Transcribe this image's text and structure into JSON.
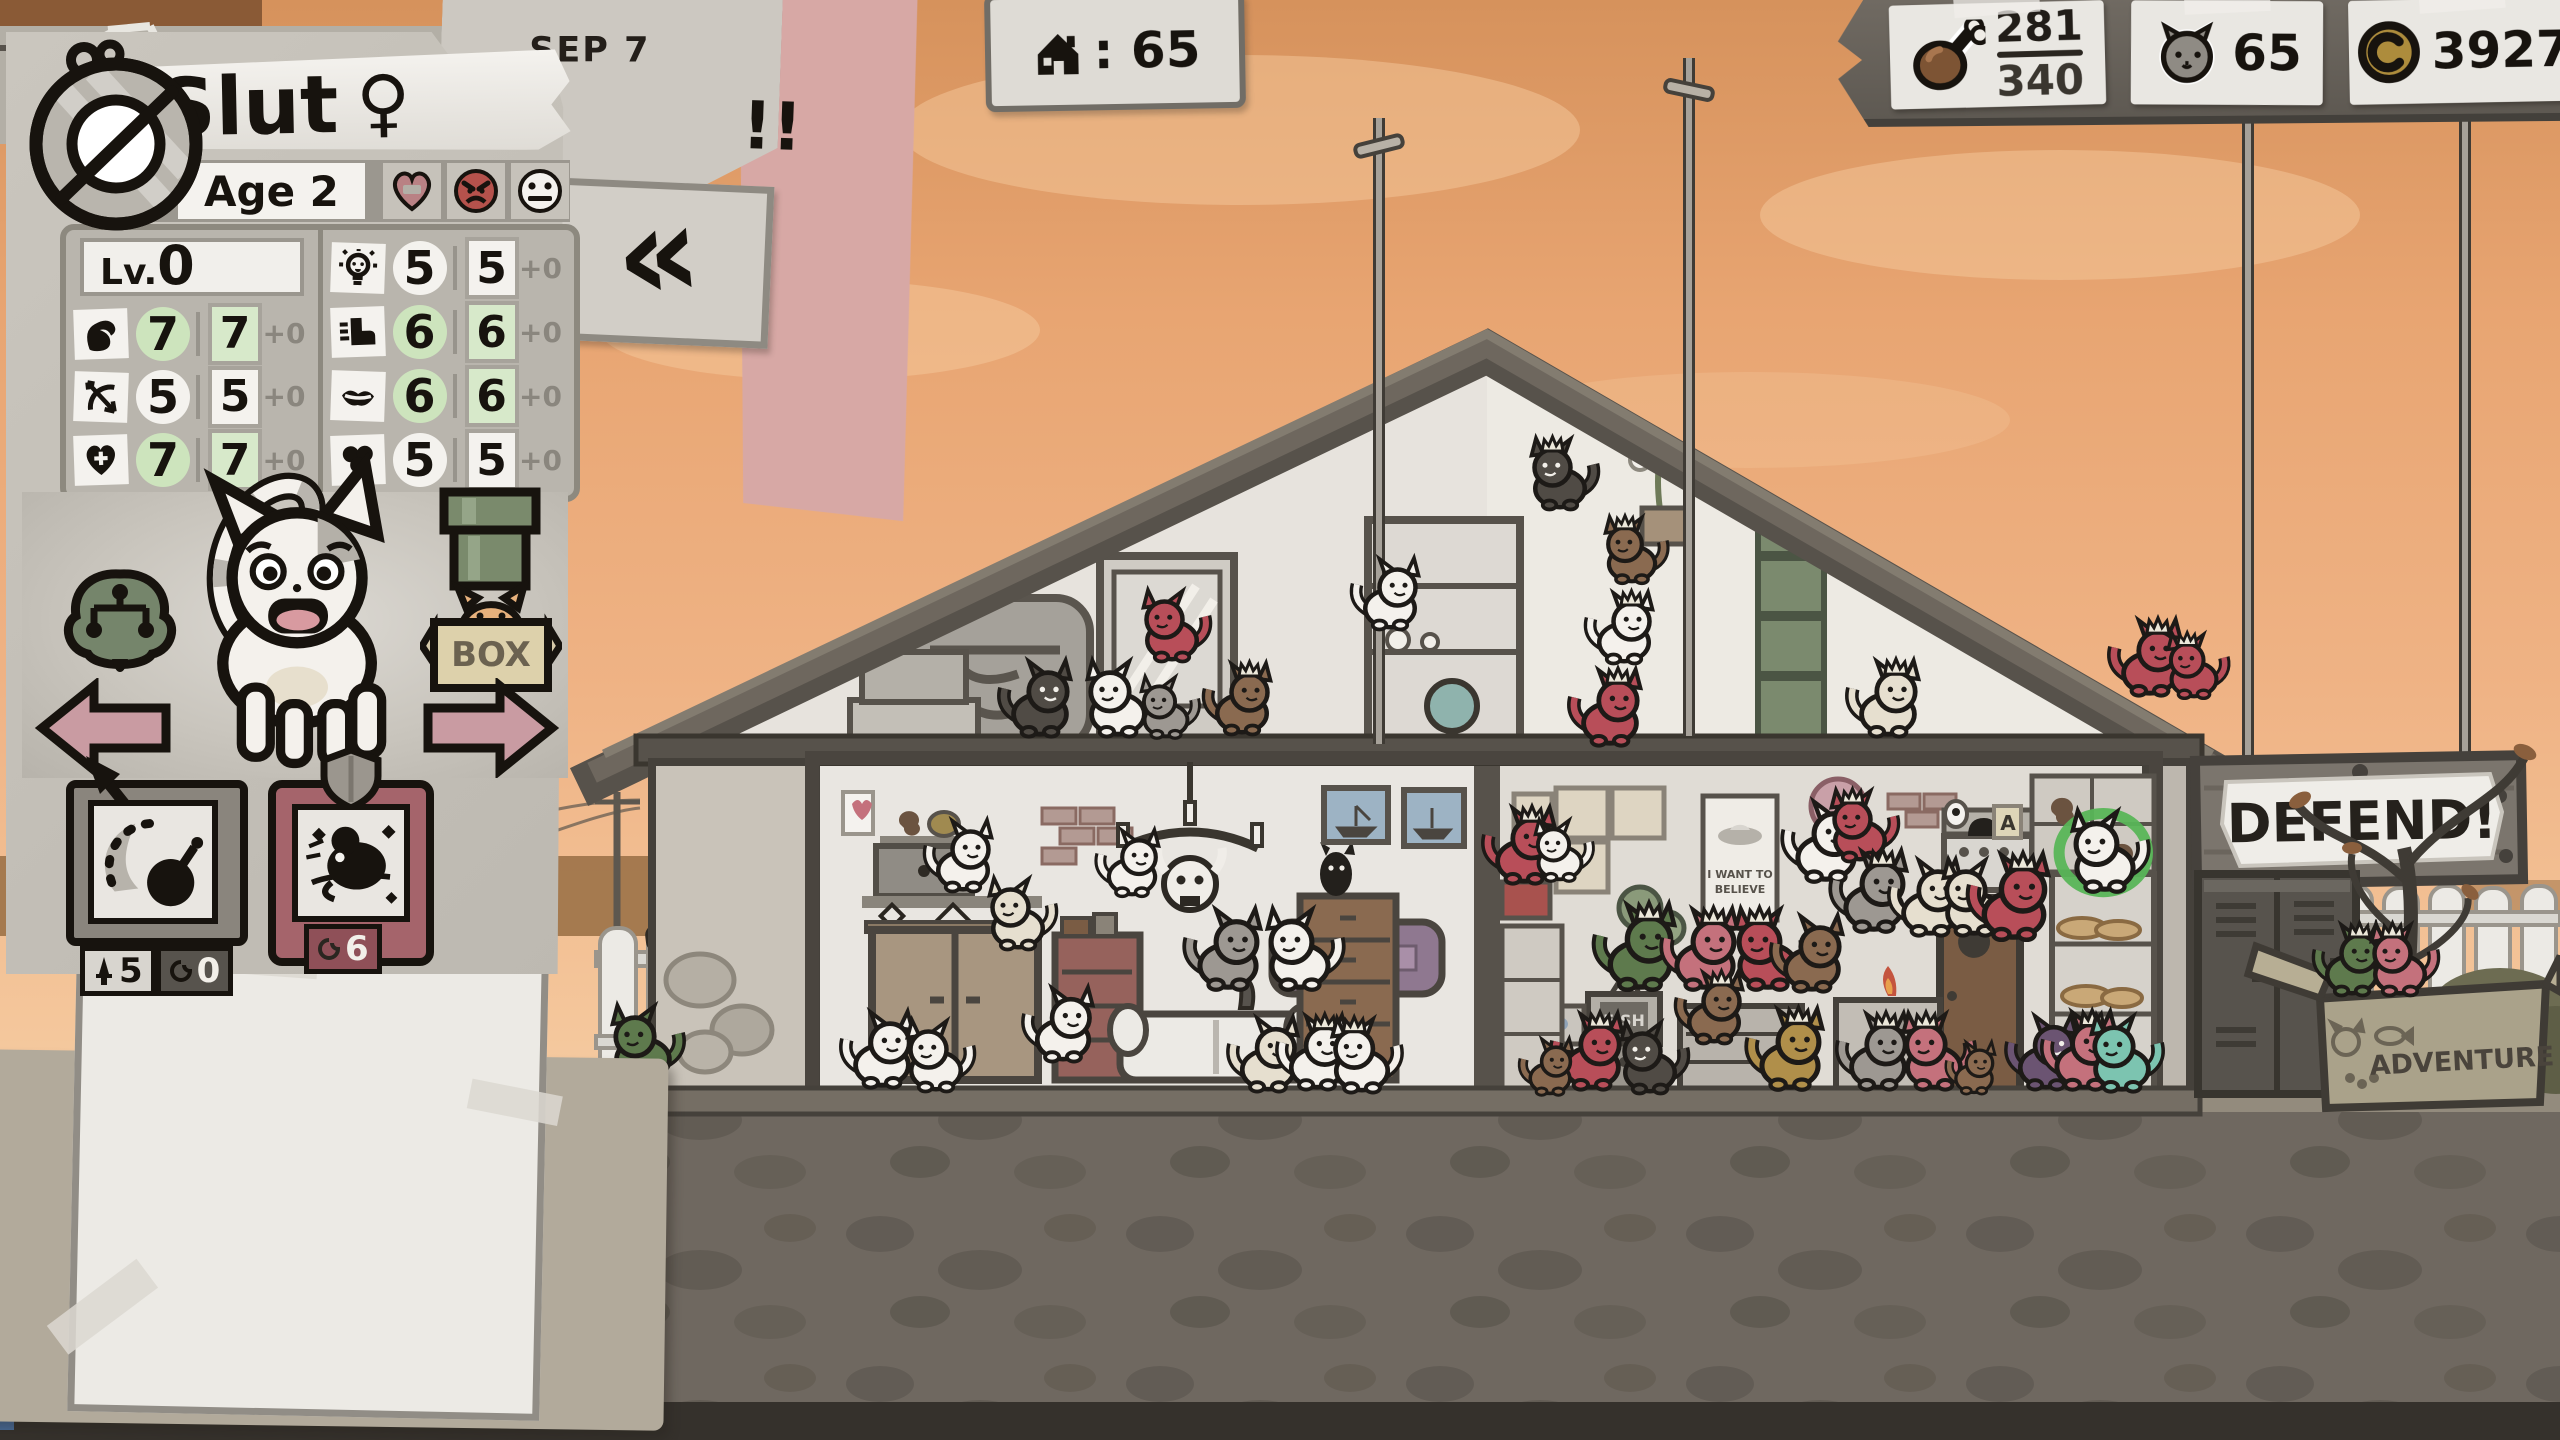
{
  "hud": {
    "date": "Sep 7",
    "date_alert": "!!",
    "back_button_glyph": "«",
    "house_counter": {
      "icon": "house-icon",
      "value": ": 65"
    },
    "resources": {
      "food": {
        "icon": "drumstick-icon",
        "current": "281",
        "max": "340"
      },
      "cats": {
        "icon": "cat-head-icon",
        "value": "65"
      },
      "coins": {
        "icon": "coin-icon",
        "value": "3927"
      }
    }
  },
  "character": {
    "badge": "prohibition-medallion",
    "name": "Slut",
    "gender": "♀",
    "age": "Age 2",
    "level_label": "Lv.",
    "level_value": "0",
    "moods": [
      "heart-minus",
      "angry-face",
      "neutral-face"
    ],
    "stats_left": [
      {
        "stat": "strength",
        "base": "7",
        "current": "7",
        "mod": "+0",
        "green": true
      },
      {
        "stat": "dexterity",
        "base": "5",
        "current": "5",
        "mod": "+0",
        "green": false
      },
      {
        "stat": "vitality",
        "base": "7",
        "current": "7",
        "mod": "+0",
        "green": true
      }
    ],
    "stats_right": [
      {
        "stat": "intelligence",
        "base": "5",
        "current": "5",
        "mod": "+0",
        "green": false
      },
      {
        "stat": "speed",
        "base": "6",
        "current": "6",
        "mod": "+0",
        "green": true
      },
      {
        "stat": "charisma",
        "base": "6",
        "current": "6",
        "mod": "+0",
        "green": true
      },
      {
        "stat": "luck",
        "base": "5",
        "current": "5",
        "mod": "+0",
        "green": false
      }
    ],
    "box_button": "BOX",
    "abilities": [
      {
        "name": "bomb-lob",
        "attack": "5",
        "uses": "0"
      },
      {
        "name": "rat",
        "uses": "6"
      }
    ]
  },
  "scene": {
    "defend_sign": "DEFEND!",
    "adventure_box_label": "ADVENTURE",
    "poster_line1": "I WANT TO",
    "poster_line2": "BELIEVE",
    "tv_label": "FISH",
    "shelf_tag": "A",
    "cat_colors": {
      "W": "#f4f1ec",
      "G": "#9d9892",
      "D": "#504b45",
      "R": "#b84e59",
      "P": "#c4717c",
      "N": "#8a6a50",
      "V": "#5e7a4d",
      "T": "#7cc4b0",
      "C": "#e6dfcf",
      "O": "#b08f4a",
      "U": "#6b5472"
    },
    "dark_eye_colors": [
      "D",
      "U"
    ],
    "selection_color": "#58b557",
    "cats": [
      {
        "x": 1040,
        "y": 735,
        "s": 0.8,
        "c": "D"
      },
      {
        "x": 1118,
        "y": 735,
        "s": 0.8,
        "c": "W",
        "f": 1
      },
      {
        "x": 1166,
        "y": 737,
        "s": 0.65,
        "c": "G",
        "f": 1
      },
      {
        "x": 1242,
        "y": 733,
        "s": 0.75,
        "c": "N",
        "k": 1
      },
      {
        "x": 1172,
        "y": 660,
        "s": 0.75,
        "c": "R",
        "f": 1
      },
      {
        "x": 1390,
        "y": 628,
        "s": 0.75,
        "c": "W"
      },
      {
        "x": 1560,
        "y": 508,
        "s": 0.75,
        "c": "D",
        "k": 1,
        "f": 1
      },
      {
        "x": 1632,
        "y": 582,
        "s": 0.7,
        "c": "N",
        "k": 1,
        "f": 1
      },
      {
        "x": 1624,
        "y": 662,
        "s": 0.75,
        "c": "W",
        "k": 1
      },
      {
        "x": 1610,
        "y": 744,
        "s": 0.8,
        "c": "R",
        "k": 1
      },
      {
        "x": 1888,
        "y": 735,
        "s": 0.8,
        "c": "C",
        "k": 1
      },
      {
        "x": 2150,
        "y": 694,
        "s": 0.8,
        "c": "R",
        "k": 1
      },
      {
        "x": 2194,
        "y": 697,
        "s": 0.68,
        "c": "R",
        "k": 1,
        "f": 1
      },
      {
        "x": 963,
        "y": 890,
        "s": 0.75,
        "c": "W"
      },
      {
        "x": 1018,
        "y": 948,
        "s": 0.75,
        "c": "C",
        "f": 1
      },
      {
        "x": 1132,
        "y": 895,
        "s": 0.7,
        "c": "W"
      },
      {
        "x": 1228,
        "y": 988,
        "s": 0.85,
        "c": "G"
      },
      {
        "x": 1300,
        "y": 988,
        "s": 0.85,
        "c": "W",
        "f": 1
      },
      {
        "x": 882,
        "y": 1086,
        "s": 0.8,
        "c": "W"
      },
      {
        "x": 936,
        "y": 1090,
        "s": 0.75,
        "c": "W",
        "f": 1
      },
      {
        "x": 1063,
        "y": 1060,
        "s": 0.78,
        "c": "W"
      },
      {
        "x": 1268,
        "y": 1090,
        "s": 0.78,
        "c": "C"
      },
      {
        "x": 1317,
        "y": 1088,
        "s": 0.78,
        "c": "W",
        "k": 1
      },
      {
        "x": 1362,
        "y": 1091,
        "s": 0.78,
        "c": "W",
        "k": 1,
        "f": 1
      },
      {
        "x": 1524,
        "y": 882,
        "s": 0.8,
        "c": "R",
        "k": 1
      },
      {
        "x": 1560,
        "y": 880,
        "s": 0.65,
        "c": "W",
        "f": 1
      },
      {
        "x": 1640,
        "y": 988,
        "s": 0.9,
        "c": "V",
        "k": 1
      },
      {
        "x": 1705,
        "y": 988,
        "s": 0.85,
        "c": "P",
        "k": 1
      },
      {
        "x": 1768,
        "y": 988,
        "s": 0.85,
        "c": "R",
        "k": 1,
        "f": 1
      },
      {
        "x": 1812,
        "y": 990,
        "s": 0.8,
        "c": "N"
      },
      {
        "x": 1714,
        "y": 1042,
        "s": 0.75,
        "c": "N",
        "k": 1
      },
      {
        "x": 1826,
        "y": 880,
        "s": 0.85,
        "c": "W"
      },
      {
        "x": 1860,
        "y": 860,
        "s": 0.75,
        "c": "R",
        "k": 1,
        "f": 1
      },
      {
        "x": 1874,
        "y": 930,
        "s": 0.85,
        "c": "G",
        "k": 1
      },
      {
        "x": 1930,
        "y": 934,
        "s": 0.8,
        "c": "C"
      },
      {
        "x": 1974,
        "y": 934,
        "s": 0.8,
        "c": "C",
        "f": 1
      },
      {
        "x": 2014,
        "y": 938,
        "s": 0.9,
        "c": "R",
        "k": 1
      },
      {
        "x": 2105,
        "y": 890,
        "s": 0.85,
        "c": "W",
        "sel": 1,
        "f": 1
      },
      {
        "x": 1790,
        "y": 1088,
        "s": 0.85,
        "c": "O",
        "k": 1
      },
      {
        "x": 1592,
        "y": 1088,
        "s": 0.8,
        "c": "R",
        "k": 1
      },
      {
        "x": 1650,
        "y": 1092,
        "s": 0.75,
        "c": "D",
        "f": 1
      },
      {
        "x": 1550,
        "y": 1094,
        "s": 0.6,
        "c": "N"
      },
      {
        "x": 1878,
        "y": 1088,
        "s": 0.8,
        "c": "G",
        "k": 1
      },
      {
        "x": 1934,
        "y": 1088,
        "s": 0.8,
        "c": "P",
        "k": 1,
        "f": 1
      },
      {
        "x": 1974,
        "y": 1093,
        "s": 0.55,
        "c": "N"
      },
      {
        "x": 2046,
        "y": 1088,
        "s": 0.78,
        "c": "U"
      },
      {
        "x": 2084,
        "y": 1088,
        "s": 0.82,
        "c": "P",
        "k": 1
      },
      {
        "x": 2122,
        "y": 1090,
        "s": 0.8,
        "c": "T",
        "f": 1
      },
      {
        "x": 643,
        "y": 1080,
        "s": 0.8,
        "c": "V",
        "f": 1
      },
      {
        "x": 2352,
        "y": 994,
        "s": 0.75,
        "c": "V",
        "k": 1
      },
      {
        "x": 2400,
        "y": 994,
        "s": 0.75,
        "c": "P",
        "k": 1,
        "f": 1
      }
    ]
  }
}
